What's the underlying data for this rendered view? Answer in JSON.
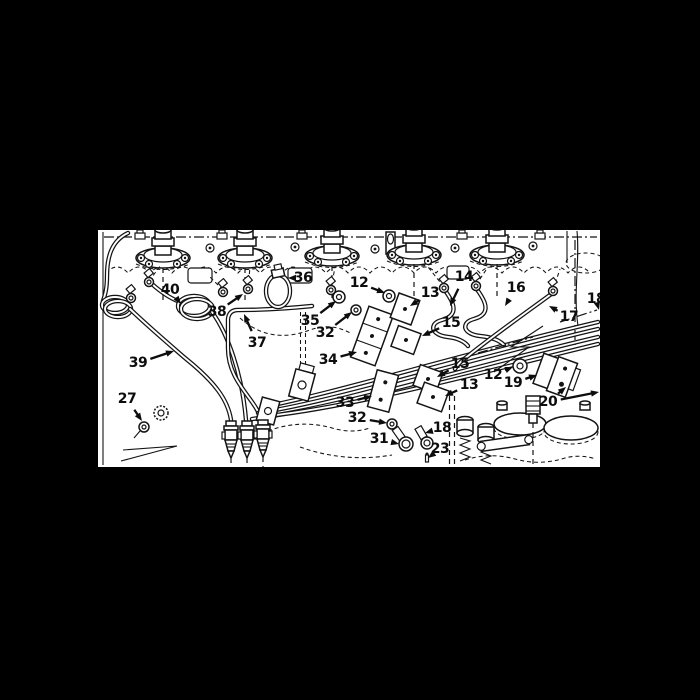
{
  "figure": {
    "type": "technical-parts-diagram",
    "subject": "engine fuel injector lines exploded parts illustration",
    "background_color": "#000000",
    "panel_color": "#ffffff",
    "ink_color": "#141414",
    "panel": {
      "x": 98,
      "y": 230,
      "width": 502,
      "height": 237
    },
    "callouts": [
      {
        "id": "36",
        "label": "36",
        "x": 303,
        "y": 278,
        "tips": [
          [
            288,
            278
          ]
        ]
      },
      {
        "id": "40",
        "label": "40",
        "x": 170,
        "y": 290,
        "tips": [
          [
            181,
            304
          ]
        ]
      },
      {
        "id": "38",
        "label": "38",
        "x": 217,
        "y": 312,
        "tips": [
          [
            243,
            294
          ]
        ]
      },
      {
        "id": "37",
        "label": "37",
        "x": 257,
        "y": 343,
        "tips": [
          [
            244,
            314
          ]
        ]
      },
      {
        "id": "39",
        "label": "39",
        "x": 138,
        "y": 363,
        "tips": [
          [
            174,
            351
          ]
        ]
      },
      {
        "id": "35",
        "label": "35",
        "x": 310,
        "y": 321,
        "tips": [
          [
            336,
            301
          ]
        ]
      },
      {
        "id": "32-upper",
        "label": "32",
        "x": 325,
        "y": 333,
        "tips": [
          [
            352,
            312
          ]
        ]
      },
      {
        "id": "34",
        "label": "34",
        "x": 328,
        "y": 360,
        "tips": [
          [
            357,
            352
          ]
        ]
      },
      {
        "id": "12-upper",
        "label": "12",
        "x": 359,
        "y": 283,
        "tips": [
          [
            385,
            293
          ]
        ]
      },
      {
        "id": "13-upper",
        "label": "13",
        "x": 430,
        "y": 293,
        "tips": [
          [
            410,
            306
          ]
        ]
      },
      {
        "id": "14",
        "label": "14",
        "x": 464,
        "y": 277,
        "tips": [
          [
            450,
            306
          ]
        ]
      },
      {
        "id": "16",
        "label": "16",
        "x": 516,
        "y": 288,
        "tips": [
          [
            505,
            306
          ]
        ]
      },
      {
        "id": "17",
        "label": "17",
        "x": 569,
        "y": 317,
        "tips": [
          [
            549,
            306
          ]
        ]
      },
      {
        "id": "18-right",
        "label": "18",
        "x": 596,
        "y": 299,
        "tips": [
          [
            599,
            310
          ]
        ]
      },
      {
        "id": "15-upper",
        "label": "15",
        "x": 451,
        "y": 323,
        "tips": [
          [
            422,
            336
          ]
        ]
      },
      {
        "id": "15-lower",
        "label": "15",
        "x": 460,
        "y": 364,
        "tips": [
          [
            437,
            377
          ]
        ]
      },
      {
        "id": "13-lower",
        "label": "13",
        "x": 469,
        "y": 385,
        "tips": [
          [
            445,
            396
          ]
        ]
      },
      {
        "id": "33",
        "label": "33",
        "x": 345,
        "y": 403,
        "tips": [
          [
            372,
            396
          ]
        ]
      },
      {
        "id": "32-lower",
        "label": "32",
        "x": 357,
        "y": 418,
        "tips": [
          [
            387,
            423
          ]
        ]
      },
      {
        "id": "31",
        "label": "31",
        "x": 379,
        "y": 439,
        "tips": [
          [
            399,
            444
          ]
        ]
      },
      {
        "id": "18-lower",
        "label": "18",
        "x": 442,
        "y": 428,
        "tips": [
          [
            425,
            433
          ]
        ]
      },
      {
        "id": "23",
        "label": "23",
        "x": 440,
        "y": 449,
        "tips": [
          [
            428,
            458
          ]
        ]
      },
      {
        "id": "27",
        "label": "27",
        "x": 127,
        "y": 399,
        "tips": [
          [
            142,
            421
          ]
        ]
      },
      {
        "id": "12-right",
        "label": "12",
        "x": 493,
        "y": 375,
        "tips": [
          [
            513,
            367
          ]
        ]
      },
      {
        "id": "19",
        "label": "19",
        "x": 513,
        "y": 383,
        "tips": [
          [
            537,
            375
          ]
        ]
      },
      {
        "id": "20",
        "label": "20",
        "x": 548,
        "y": 402,
        "tips": [
          [
            566,
            387
          ],
          [
            599,
            392
          ]
        ]
      }
    ]
  }
}
